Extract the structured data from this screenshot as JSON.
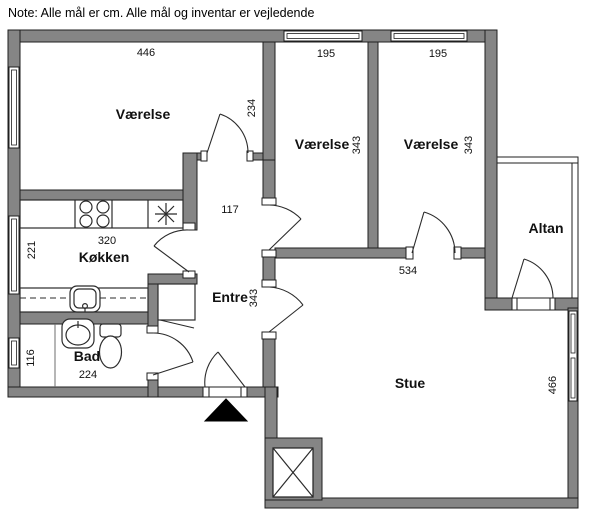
{
  "note": "Note: Alle mål er cm. Alle mål og inventar er vejledende",
  "rooms": {
    "vaerelse1": {
      "label": "Værelse",
      "dim_width": "446",
      "dim_height": "234"
    },
    "vaerelse2": {
      "label": "Værelse",
      "dim_width": "195",
      "dim_height": "343"
    },
    "vaerelse3": {
      "label": "Værelse",
      "dim_width": "195",
      "dim_height": "343"
    },
    "koekken": {
      "label": "Køkken",
      "dim_width": "320",
      "dim_height": "221"
    },
    "entre": {
      "label": "Entre",
      "dim_width": "117",
      "dim_height": "343"
    },
    "bad": {
      "label": "Bad",
      "dim_width": "224",
      "dim_height": "116"
    },
    "stue": {
      "label": "Stue",
      "dim_width": "534",
      "dim_height": "466"
    },
    "altan": {
      "label": "Altan"
    }
  },
  "colors": {
    "wall": "#858585",
    "outline": "#1f1f1f",
    "background": "#ffffff",
    "fixture_line": "#2b2b2b"
  },
  "symbols": {
    "entrance_marker": "filled-triangle",
    "shaft": "x-cross-box",
    "stove": "four-burner-circles",
    "extractor": "eight-point-star",
    "kitchen_sink": "rounded-square-basin",
    "bathroom_sink": "oval-basin",
    "toilet": "toilet-top-view"
  }
}
